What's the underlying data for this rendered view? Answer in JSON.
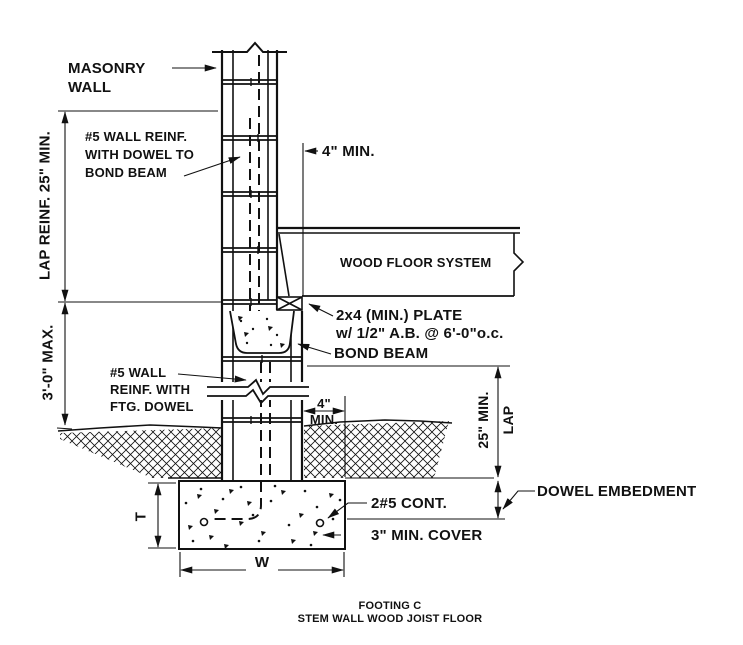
{
  "page": {
    "background": "#ffffff",
    "ink": "#111111"
  },
  "title": {
    "line1": "FOOTING C",
    "line2": "STEM WALL WOOD JOIST FLOOR"
  },
  "labels": {
    "masonry_wall_line1": "MASONRY",
    "masonry_wall_line2": "WALL",
    "wall_reinf_bond_line1": "#5 WALL REINF.",
    "wall_reinf_bond_line2": "WITH DOWEL TO",
    "wall_reinf_bond_line3": "BOND BEAM",
    "bearing_min": "4\" MIN.",
    "wood_floor_system": "WOOD FLOOR SYSTEM",
    "plate_line1": "2x4 (MIN.) PLATE",
    "plate_line2": "w/ 1/2\" A.B. @ 6'-0\"o.c.",
    "bond_beam": "BOND BEAM",
    "wall_reinf_ftg_line1": "#5 WALL",
    "wall_reinf_ftg_line2": "REINF. WITH",
    "wall_reinf_ftg_line3": "FTG. DOWEL",
    "ledge_min_line1": "4\"",
    "ledge_min_line2": "MIN.",
    "lap_right_line1": "25\" MIN.",
    "lap_right_line2": "LAP",
    "dowel_embedment": "DOWEL EMBEDMENT",
    "cont_bars": "2#5 CONT.",
    "min_cover": "3\" MIN. COVER",
    "footing_thickness": "T",
    "footing_width": "W",
    "lap_left": "LAP REINF. 25\" MIN.",
    "stem_height_max": "3'-0\" MAX."
  }
}
